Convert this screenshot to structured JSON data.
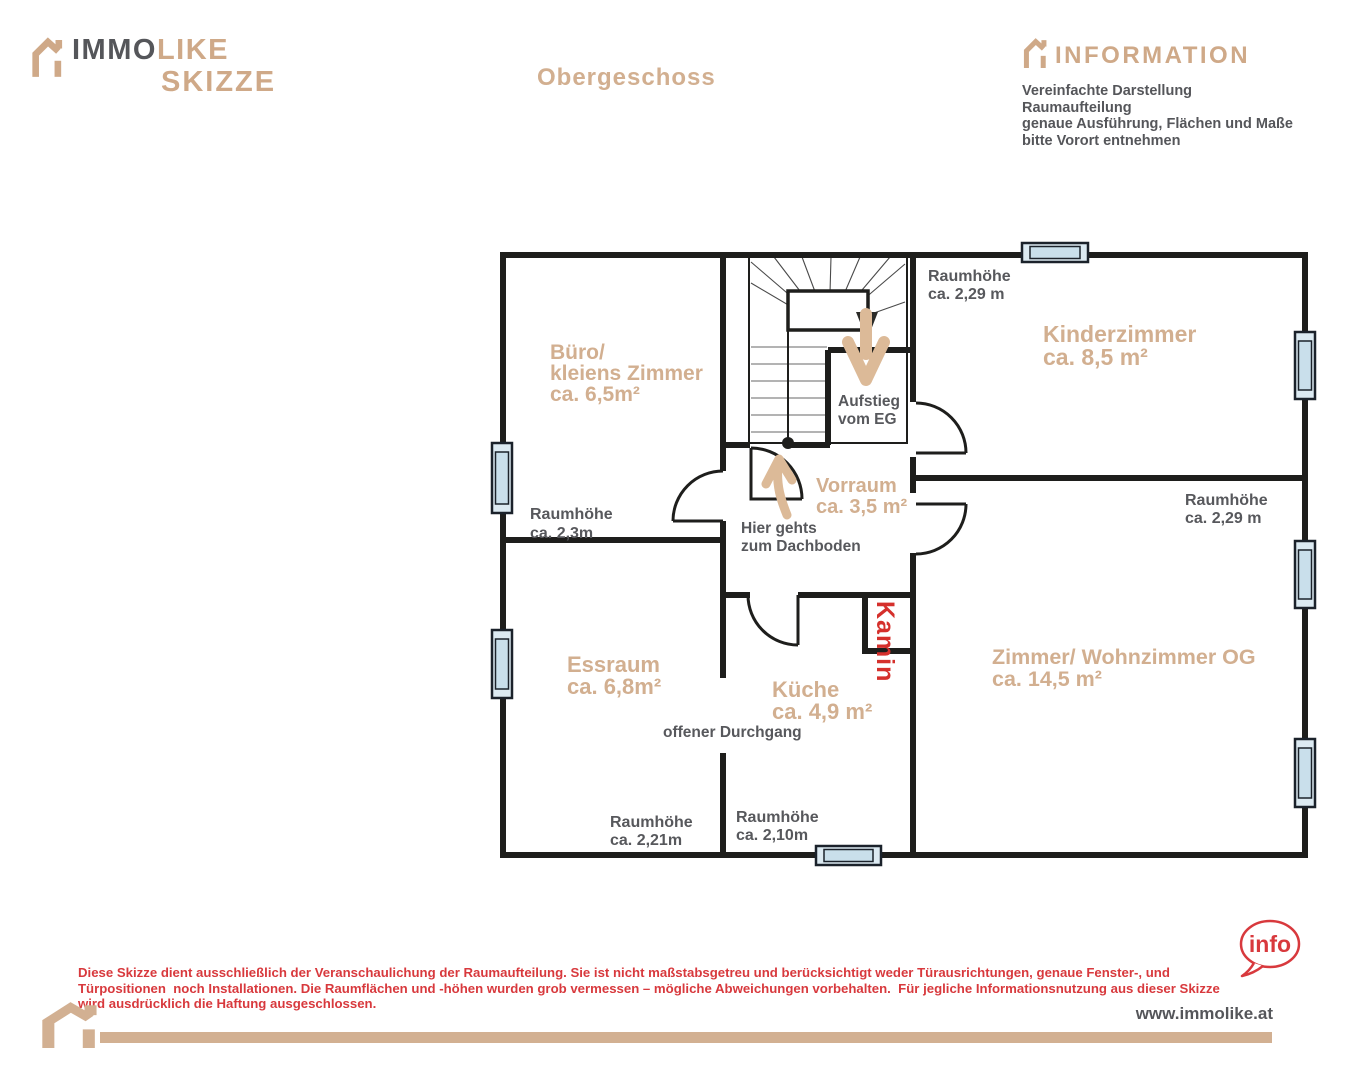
{
  "colors": {
    "tan": "#d2af90",
    "gray": "#55565a",
    "red": "#d8393d",
    "kamin_red": "#d5302c",
    "wall": "#1e1e1c",
    "window_fill": "#dceaf2"
  },
  "header": {
    "logo": {
      "word1": "IMMO",
      "word2": "LIKE",
      "word3": "SKIZZE"
    },
    "title": "Obergeschoss",
    "info_heading": "INFORMATION",
    "info_lines": [
      "Vereinfachte Darstellung",
      "Raumaufteilung",
      "genaue Ausführung, Flächen und Maße",
      "bitte Vorort entnehmen"
    ]
  },
  "plan": {
    "rooms": {
      "buero": {
        "l1": "Büro/",
        "l2": "kleiens Zimmer",
        "l3": "ca. 6,5m²"
      },
      "kinderzimmer": {
        "l1": "Kinderzimmer",
        "l2": "ca. 8,5 m²"
      },
      "vorraum": {
        "l1": "Vorraum",
        "l2": "ca. 3,5 m²"
      },
      "essraum": {
        "l1": "Essraum",
        "l2": "ca. 6,8m²"
      },
      "kueche": {
        "l1": "Küche",
        "l2": "ca. 4,9 m²"
      },
      "wohnzimmer": {
        "l1": "Zimmer/ Wohnzimmer OG",
        "l2": "ca. 14,5 m²"
      }
    },
    "annotations": {
      "rh_buero": {
        "l1": "Raumhöhe",
        "l2": "ca. 2,3m"
      },
      "rh_kinderzimmer": {
        "l1": "Raumhöhe",
        "l2": "ca. 2,29 m"
      },
      "rh_wohnzimmer": {
        "l1": "Raumhöhe",
        "l2": "ca. 2,29 m"
      },
      "rh_essraum": {
        "l1": "Raumhöhe",
        "l2": "ca. 2,21m"
      },
      "rh_kueche": {
        "l1": "Raumhöhe",
        "l2": "ca. 2,10m"
      },
      "aufstieg": {
        "l1": "Aufstieg",
        "l2": "vom EG"
      },
      "dachboden": {
        "l1": "Hier gehts",
        "l2": "zum Dachboden"
      },
      "durchgang": "offener Durchgang",
      "kamin": "Kamin"
    }
  },
  "footer": {
    "disclaimer_lines": [
      "Diese Skizze dient ausschließlich der Veranschaulichung der Raumaufteilung. Sie ist nicht maßstabsgetreu und berücksichtigt weder Türausrichtungen, genaue Fenster-, und",
      "Türpositionen  noch Installationen. Die Raumflächen und -höhen wurden grob vermessen – mögliche Abweichungen vorbehalten.  Für jegliche Informationsnutzung aus dieser Skizze",
      "wird ausdrücklich die Haftung ausgeschlossen."
    ],
    "website": "www.immolike.at",
    "info_badge": "info"
  }
}
